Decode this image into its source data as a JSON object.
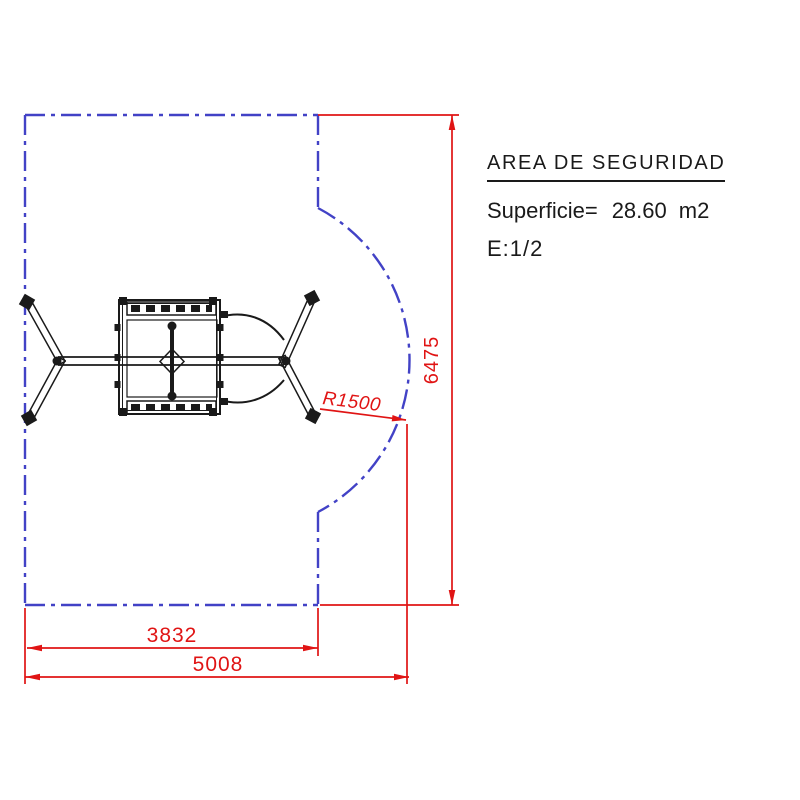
{
  "panel": {
    "title": "AREA DE SEGURIDAD",
    "surface_label": "Superficie=",
    "surface_value": "28.60",
    "surface_unit": "m2",
    "scale": "E:1/2"
  },
  "drawing": {
    "dims": {
      "height": "6475",
      "inner_width": "3832",
      "outer_width": "5008",
      "radius": "R1500"
    },
    "colors": {
      "boundary_blue": "#4242c6",
      "dimension_red": "#e01414",
      "equipment_black": "#1a1a1a"
    }
  }
}
